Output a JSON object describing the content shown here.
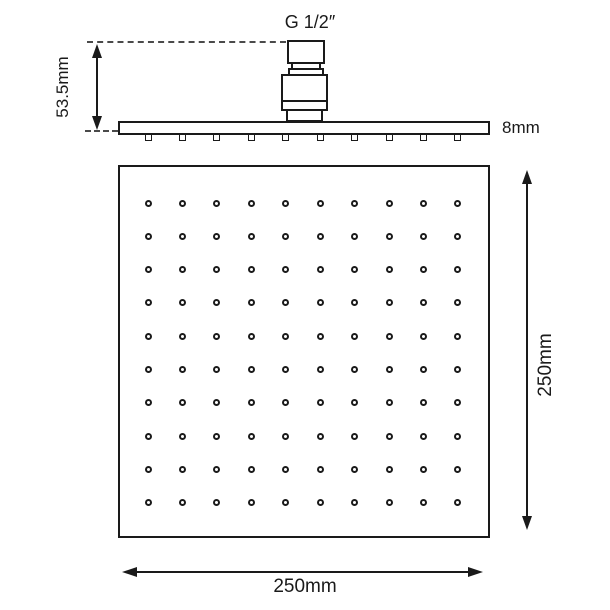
{
  "side_view": {
    "thread_label": "G 1/2″",
    "height_label": "53.5mm",
    "thickness_label": "8mm",
    "nozzle_count": 10
  },
  "front_view": {
    "width_label": "250mm",
    "height_label": "250mm",
    "nozzle_grid": {
      "rows": 10,
      "cols": 10
    }
  },
  "colors": {
    "line": "#1a1a1a",
    "dash": "#4a4a4a",
    "background": "#ffffff"
  }
}
